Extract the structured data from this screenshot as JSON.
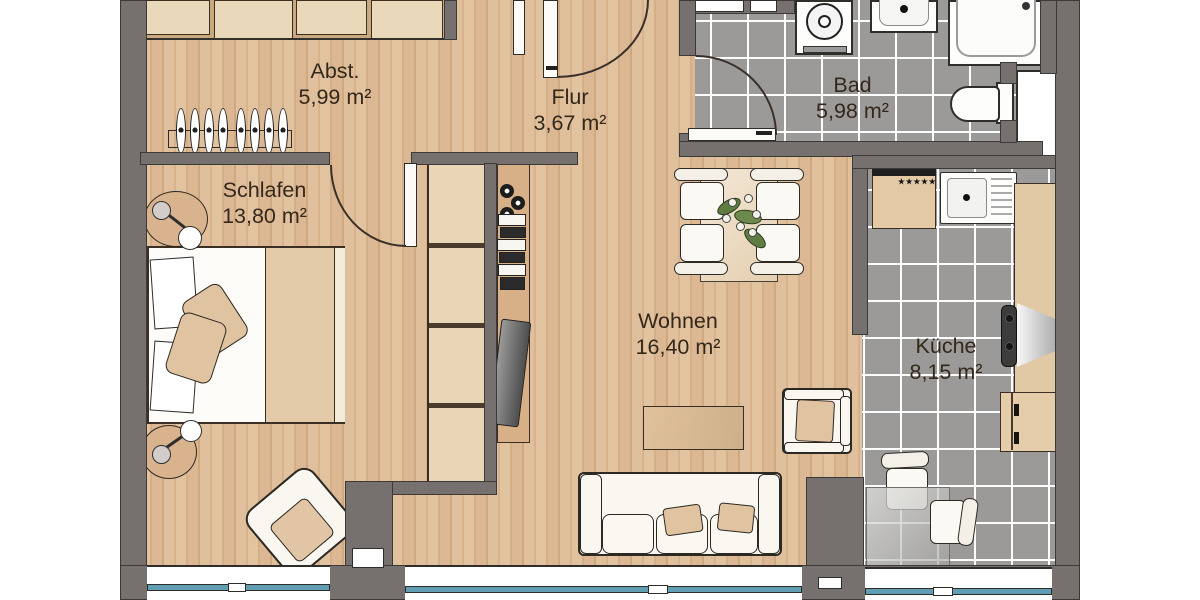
{
  "rooms": [
    {
      "name": "Abst.",
      "area": "5,99 m²"
    },
    {
      "name": "Flur",
      "area": "3,67 m²"
    },
    {
      "name": "Bad",
      "area": "5,98 m²"
    },
    {
      "name": "Schlafen",
      "area": "13,80 m²"
    },
    {
      "name": "Wohnen",
      "area": "16,40 m²"
    },
    {
      "name": "Küche",
      "area": "8,15 m²"
    }
  ],
  "kitchen": {
    "fridge_stars": "★★★★★"
  },
  "colors": {
    "wall": "#76716f",
    "wood_floor": "#dcb996",
    "tile_floor": "#9c9a99",
    "window_glass": "#5f9eb3",
    "furniture_wood": "#e7d2b2",
    "textile_beige": "#e0c3a1",
    "label_text": "#33281a"
  }
}
